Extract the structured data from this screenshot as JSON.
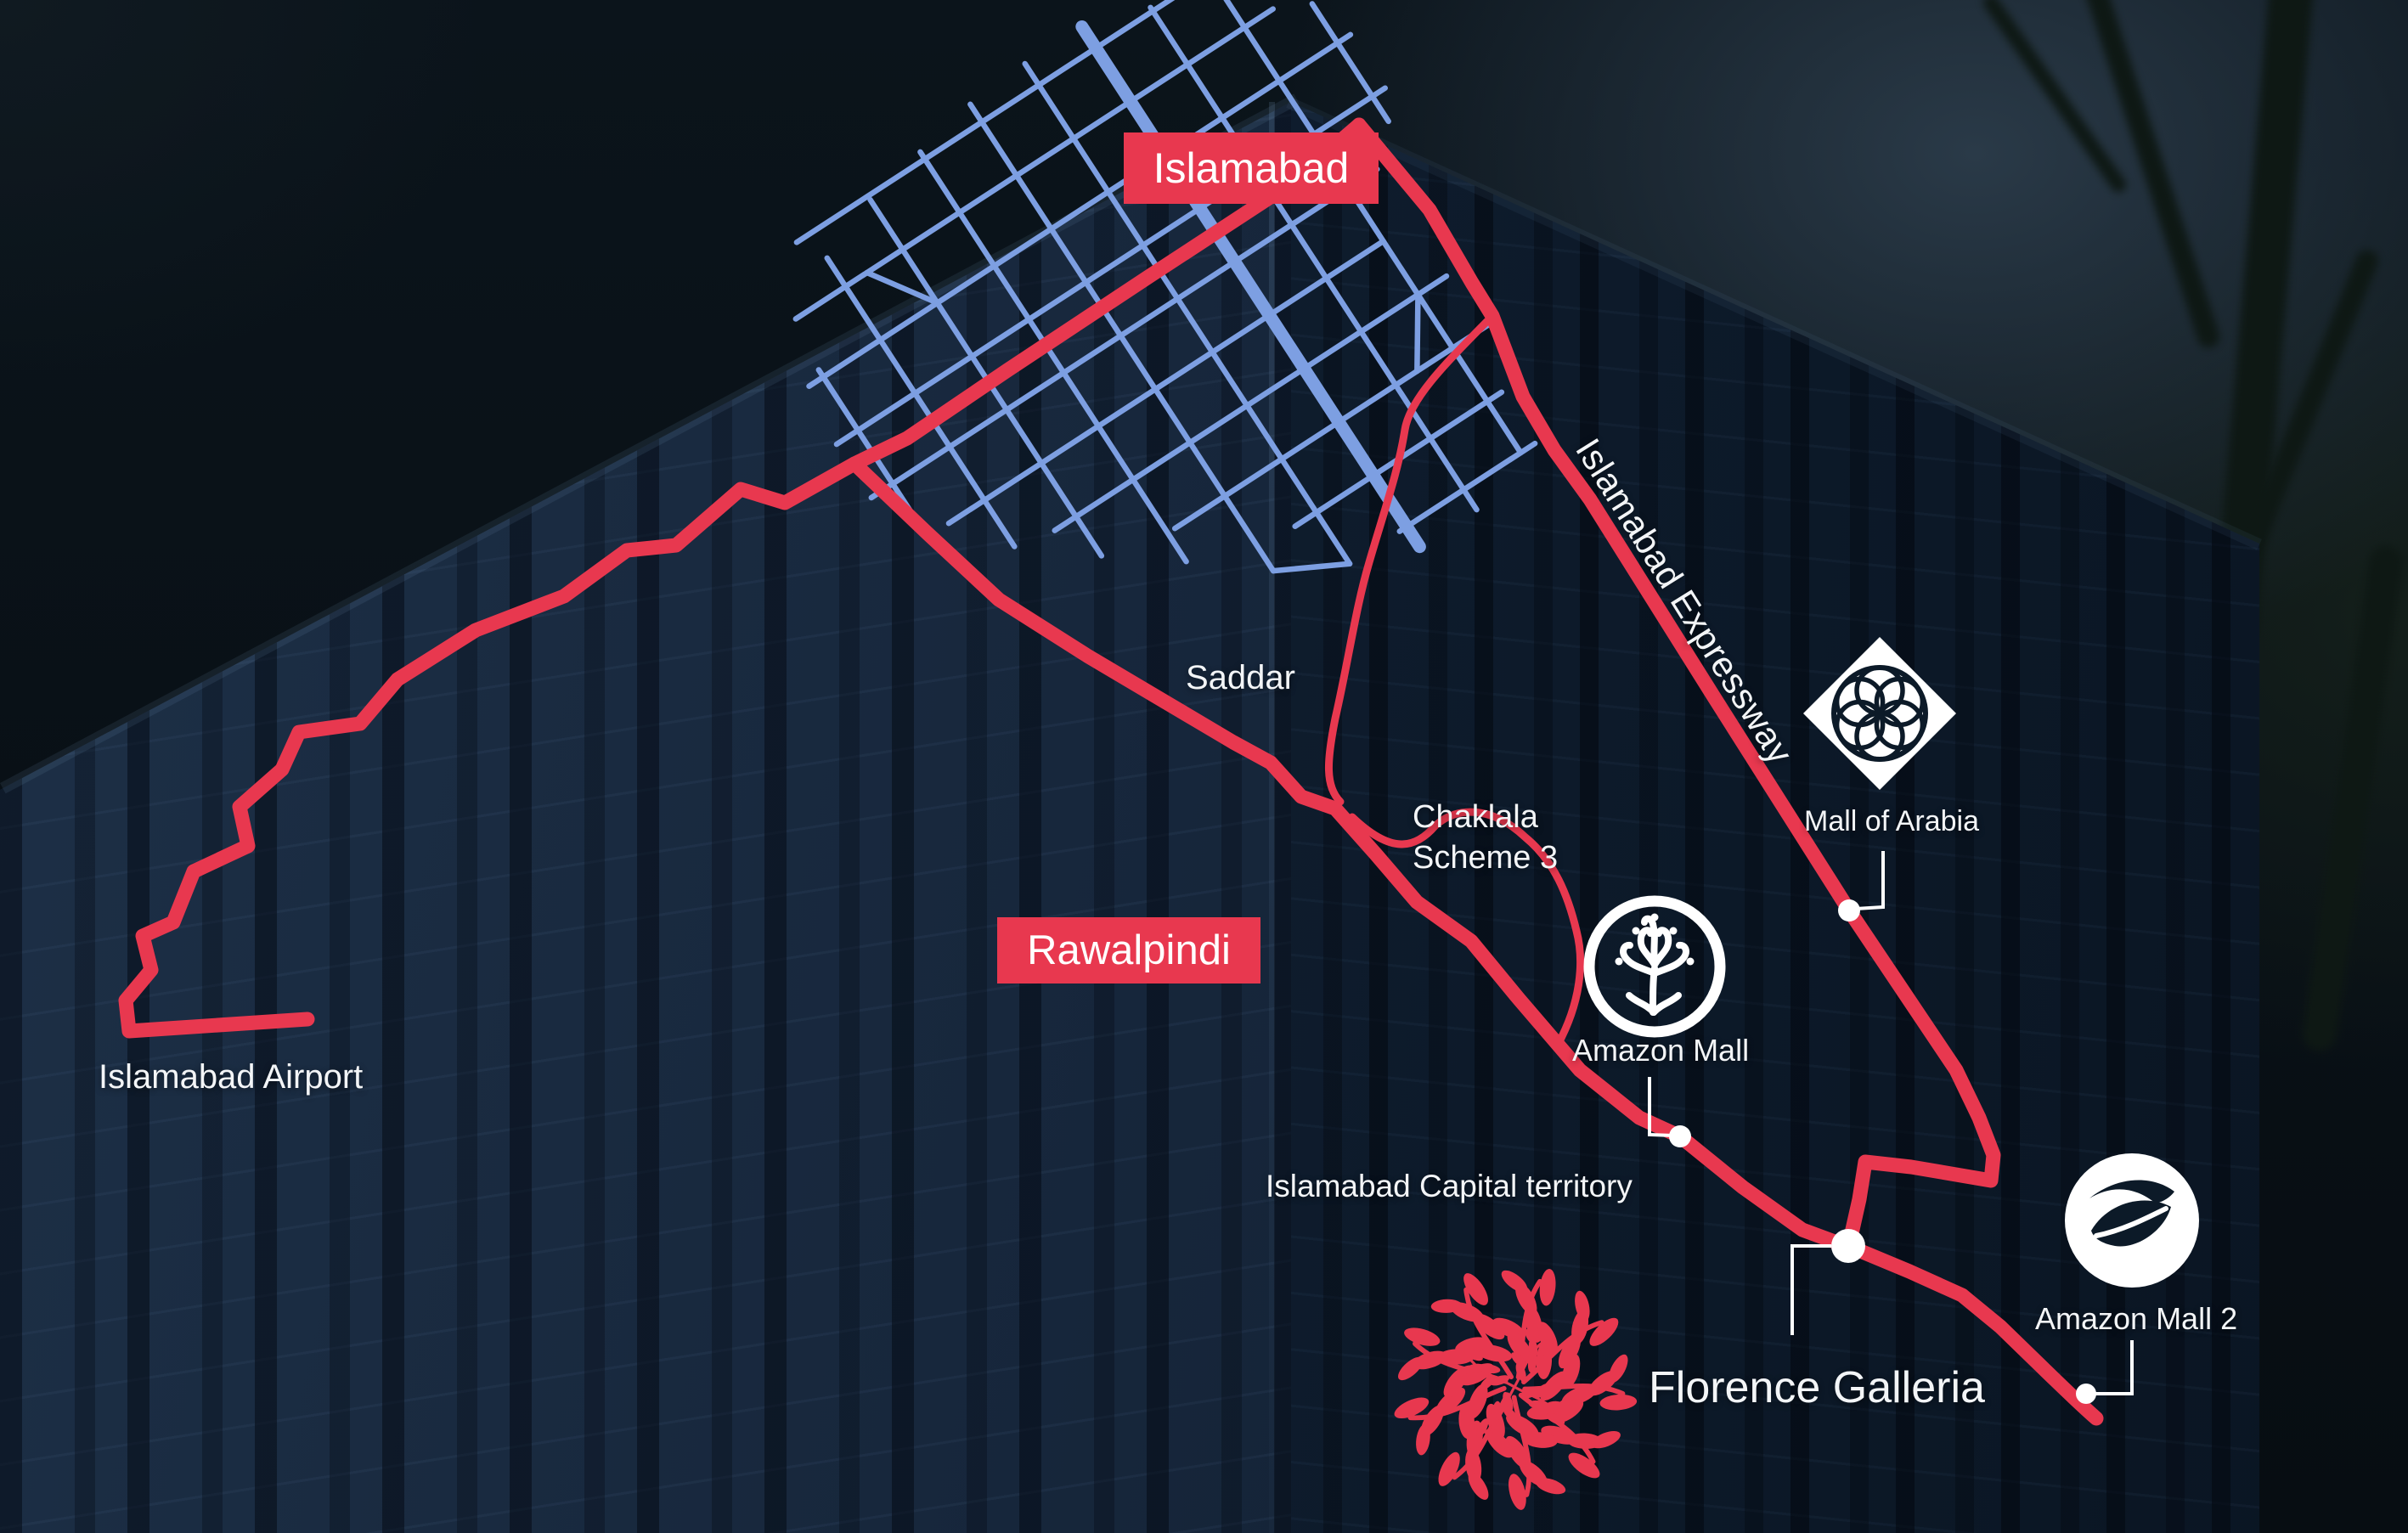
{
  "map": {
    "city_labels": [
      {
        "label": "Islamabad"
      },
      {
        "label": "Rawalpindi"
      }
    ],
    "road_labels": [
      {
        "label": "Islamabad Expressway"
      }
    ],
    "area_labels": [
      {
        "label": "Saddar"
      },
      {
        "label": "Chaklala\nScheme 3"
      },
      {
        "label": "Islamabad Capital territory"
      }
    ],
    "landmarks": [
      {
        "label": "Islamabad Airport",
        "icon": "none"
      },
      {
        "label": "Mall of Arabia",
        "icon": "arabesque-diamond-icon"
      },
      {
        "label": "Amazon Mall",
        "icon": "ornate-tree-ring-icon"
      },
      {
        "label": "Amazon Mall 2",
        "icon": "leaf-circle-icon"
      },
      {
        "label": "Florence Galleria",
        "icon": "floral-medallion-icon"
      }
    ],
    "colors": {
      "route_red": "#e8384f",
      "street_blue": "#7d9fe2",
      "marker_white": "#ffffff",
      "text_white": "#f3f5f7",
      "icon_ink": "#0c1a28"
    }
  }
}
